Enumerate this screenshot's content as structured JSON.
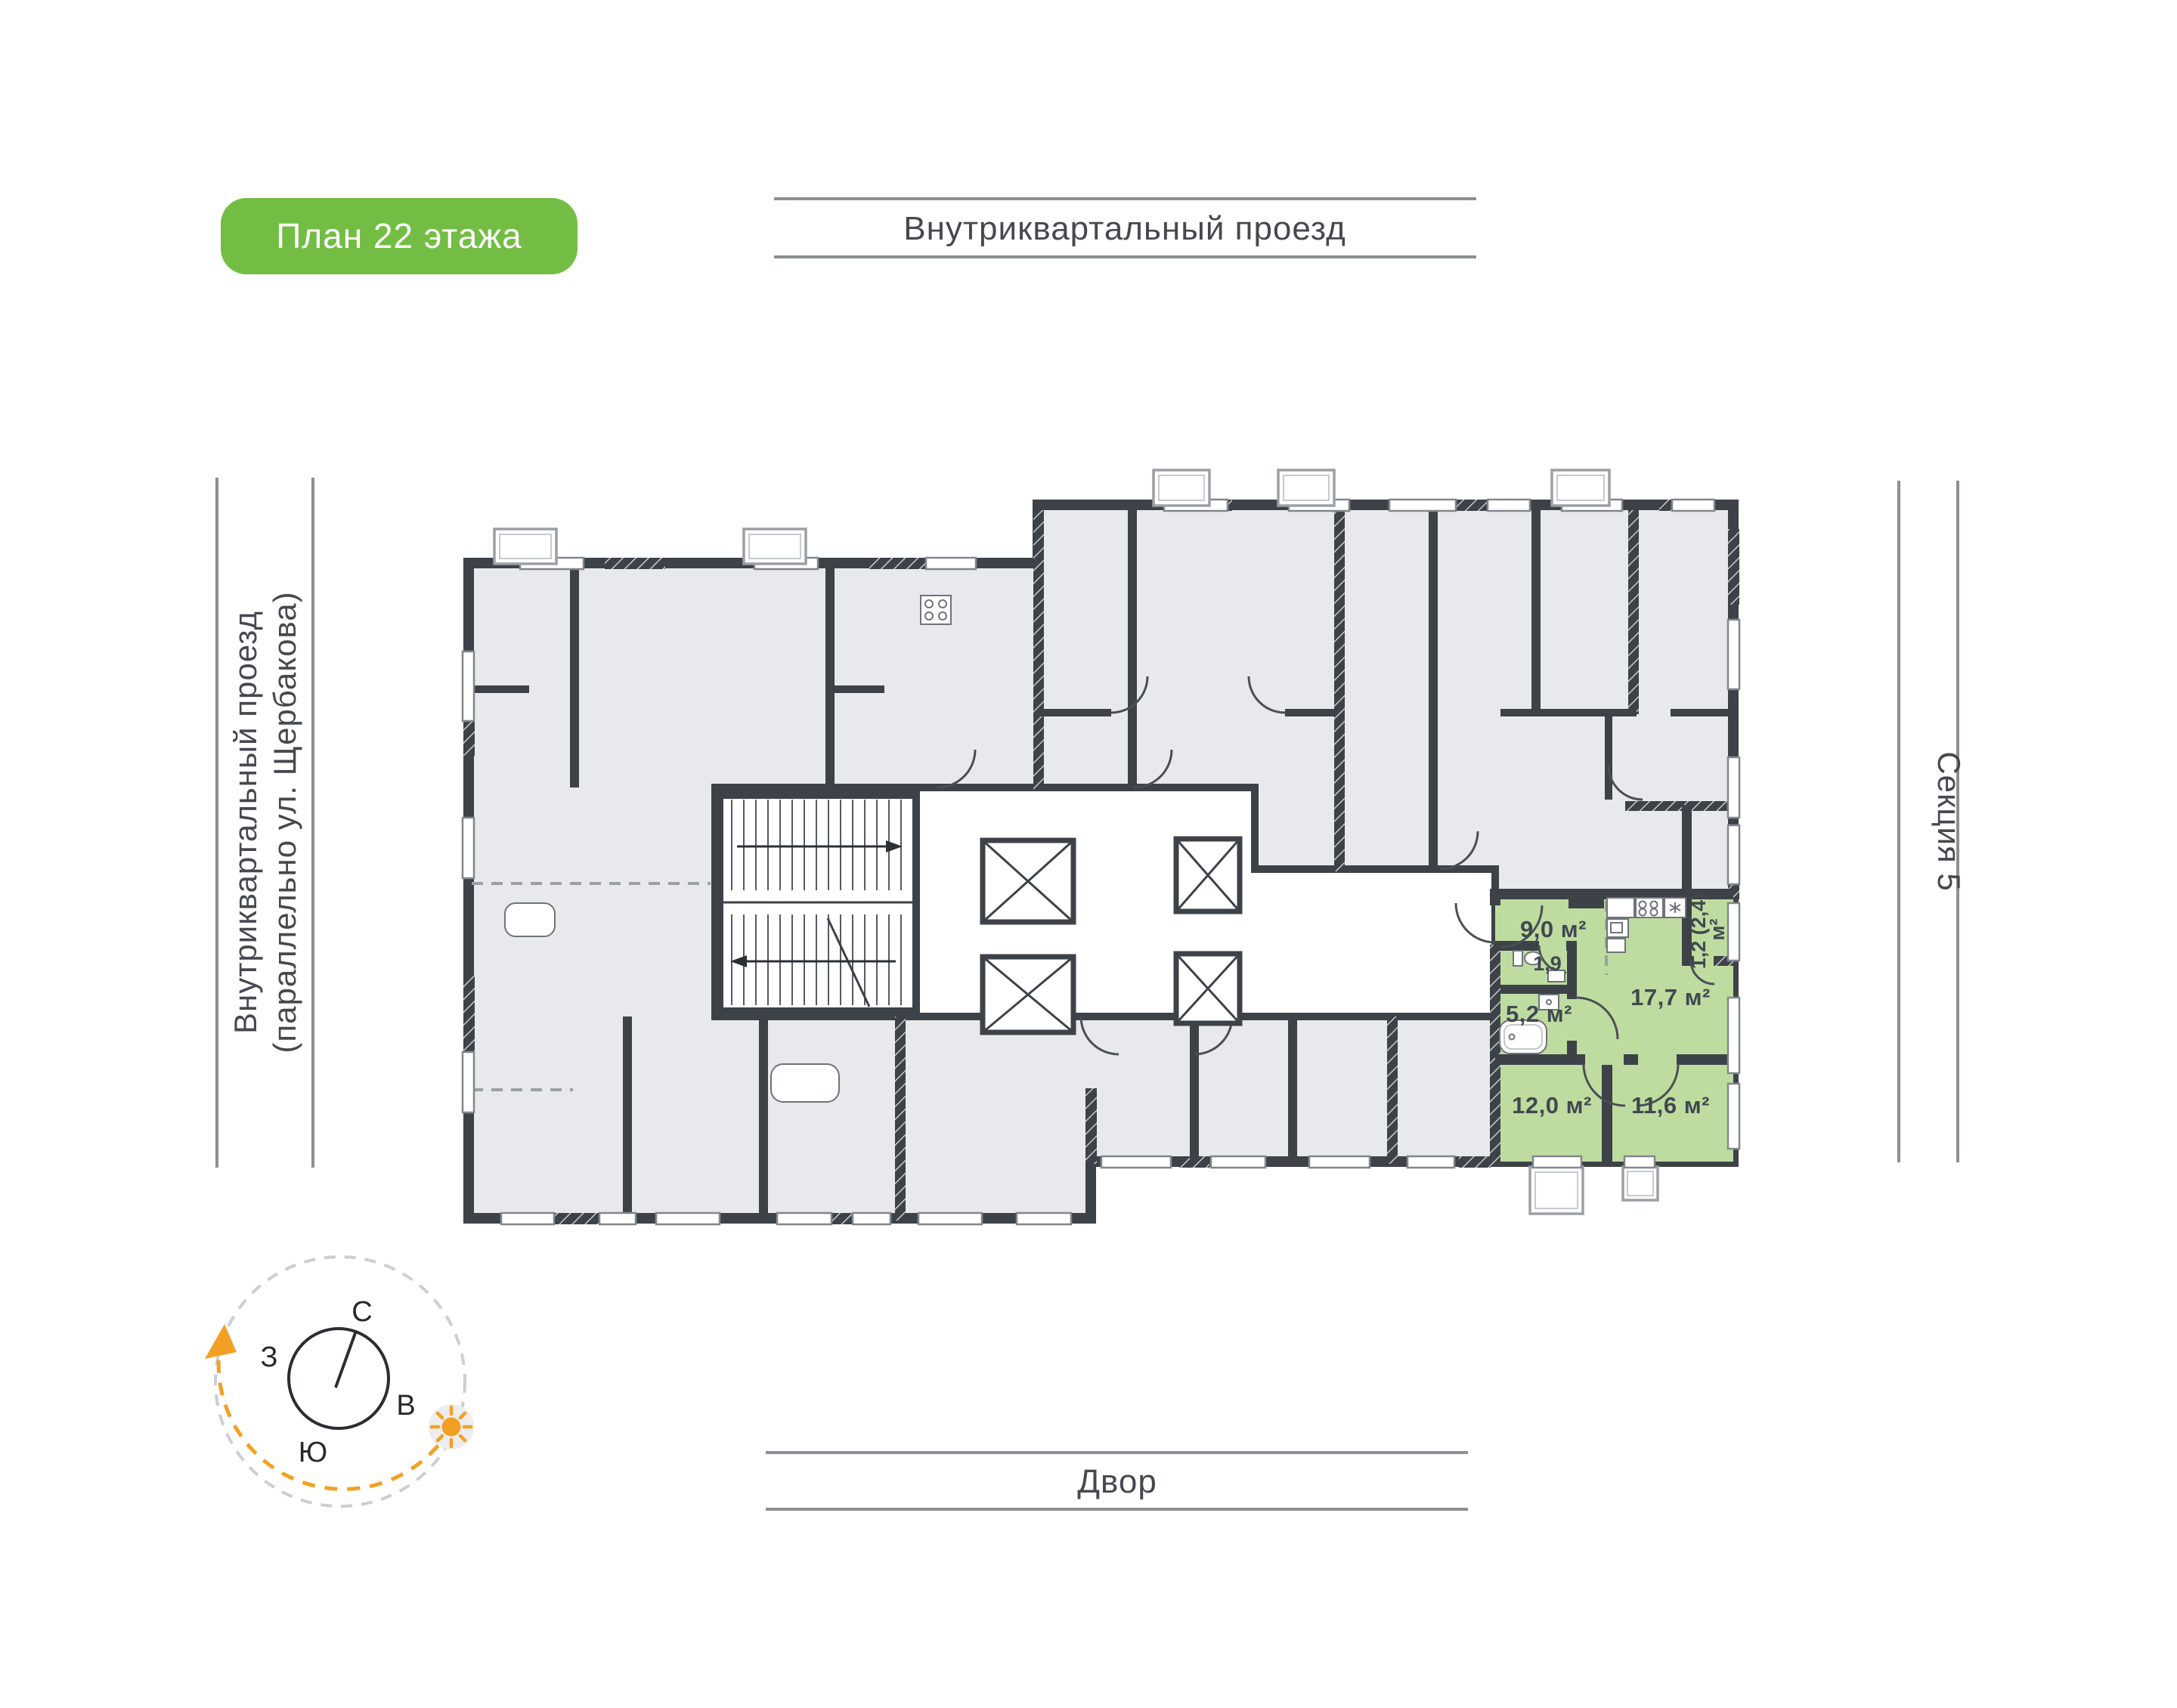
{
  "badge": {
    "label": "План 22 этажа",
    "color": "#74bd44"
  },
  "roads": {
    "top": "Внутриквартальный проезд",
    "left_line1": "Внутриквартальный проезд",
    "left_line2": "(параллельно ул. Щербакова)",
    "bottom": "Двор",
    "section": "Секция 5"
  },
  "compass": {
    "north": "С",
    "south": "Ю",
    "west": "З",
    "east": "В"
  },
  "apartment": {
    "highlight_color": "#bedc9f",
    "rooms": [
      {
        "name": "hallway",
        "area": "9,0 м²"
      },
      {
        "name": "wc",
        "area": "1,9"
      },
      {
        "name": "bathroom",
        "area": "5,2 м²"
      },
      {
        "name": "living-kitchen",
        "area": "17,7 м²"
      },
      {
        "name": "bedroom-1",
        "area": "12,0 м²"
      },
      {
        "name": "bedroom-2",
        "area": "11,6 м²"
      }
    ],
    "balcony_area_line1": "1,2 (2,4)",
    "balcony_area_line2": "м²"
  },
  "colors": {
    "accent_orange": "#f2a024",
    "wall": "#3d4248",
    "room_gray": "#e7e9ec"
  }
}
